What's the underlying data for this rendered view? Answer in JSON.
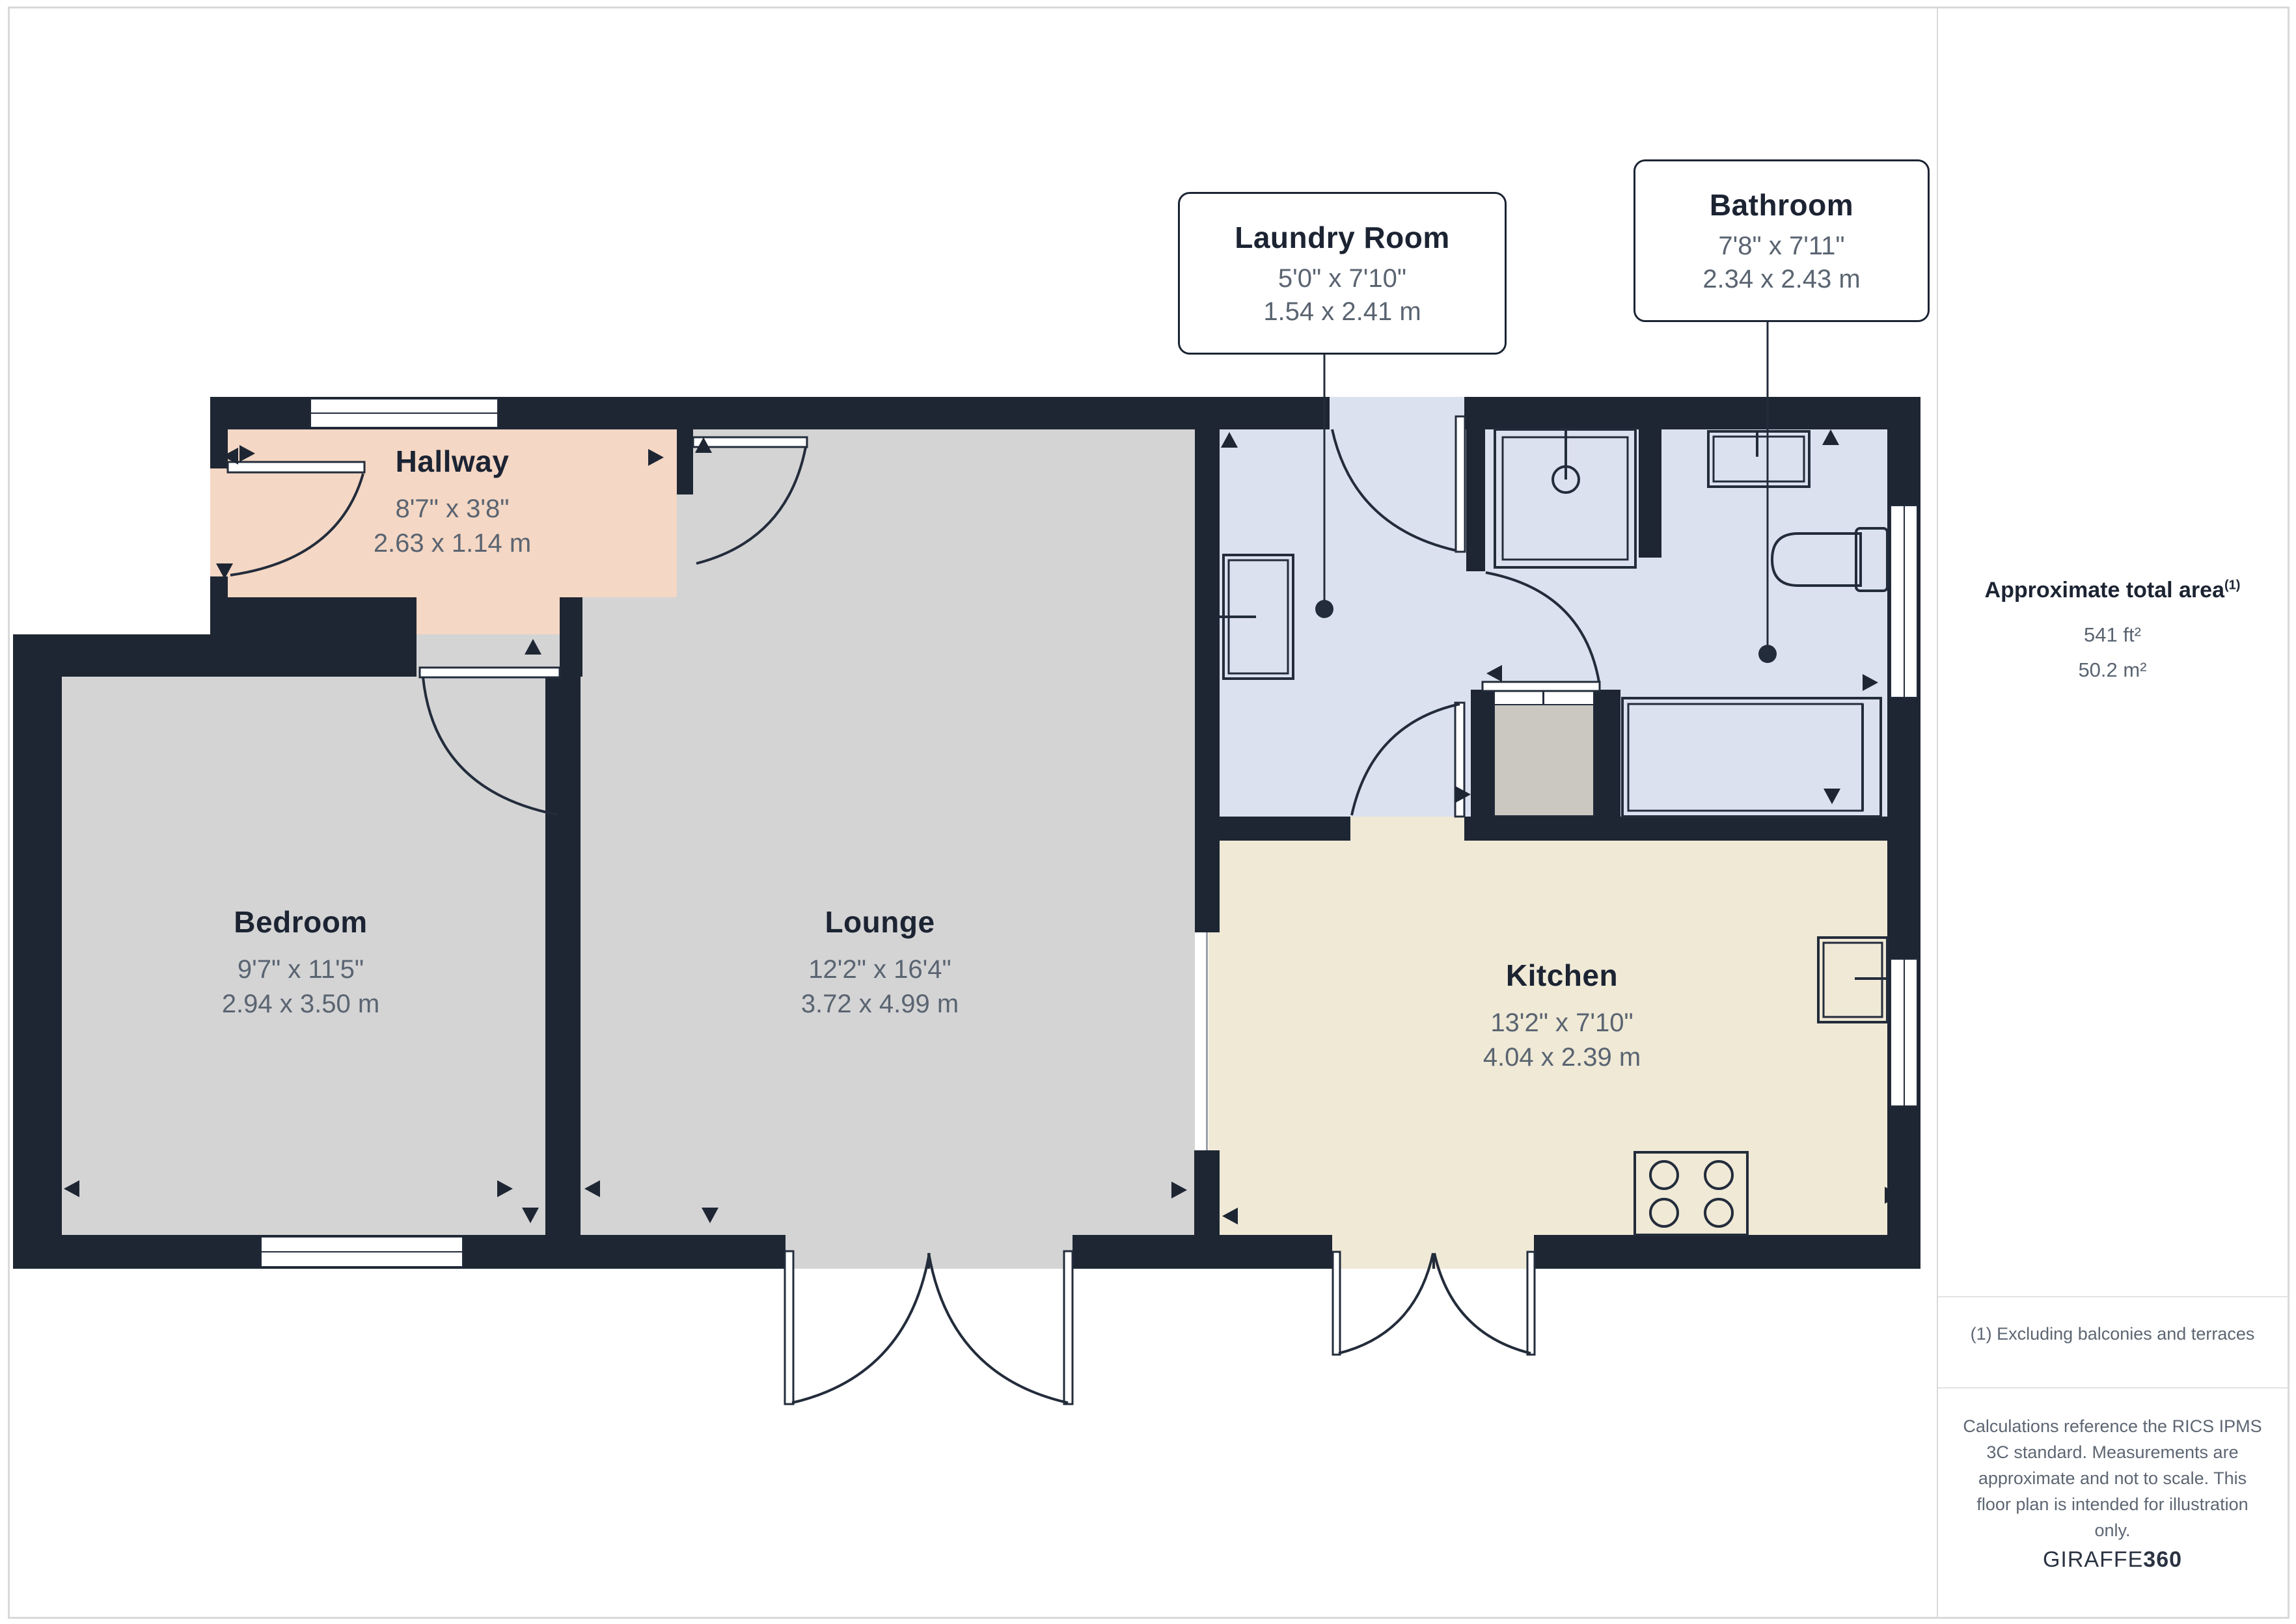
{
  "plan": {
    "rooms": {
      "hallway": {
        "name": "Hallway",
        "imperial": "8'7\" x 3'8\"",
        "metric": "2.63 x 1.14 m"
      },
      "bedroom": {
        "name": "Bedroom",
        "imperial": "9'7\" x 11'5\"",
        "metric": "2.94 x 3.50 m"
      },
      "lounge": {
        "name": "Lounge",
        "imperial": "12'2\" x 16'4\"",
        "metric": "3.72 x 4.99 m"
      },
      "kitchen": {
        "name": "Kitchen",
        "imperial": "13'2\" x 7'10\"",
        "metric": "4.04 x 2.39 m"
      },
      "laundry": {
        "name": "Laundry Room",
        "imperial": "5'0\" x 7'10\"",
        "metric": "1.54 x 2.41 m"
      },
      "bathroom": {
        "name": "Bathroom",
        "imperial": "7'8\" x 7'11\"",
        "metric": "2.34 x 2.43 m"
      }
    },
    "colors": {
      "wall": "#1e2633",
      "lounge_bedroom_floor": "#d4d4d5",
      "hallway_floor": "#f4d7c4",
      "laundry_bathroom_floor": "#dce1ef",
      "kitchen_floor": "#efe9d6",
      "cupboard": "#cbc8c2"
    }
  },
  "sidebar": {
    "title": "Approximate total area",
    "title_superscript": "(1)",
    "area_ft": "541 ft²",
    "area_m": "50.2 m²",
    "footnote": "(1) Excluding balconies and terraces",
    "disclaimer": "Calculations reference the RICS IPMS 3C standard. Measurements are approximate and not to scale. This floor plan is intended for illustration only.",
    "logo_text": "GIRAFFE",
    "logo_suffix": "360"
  }
}
